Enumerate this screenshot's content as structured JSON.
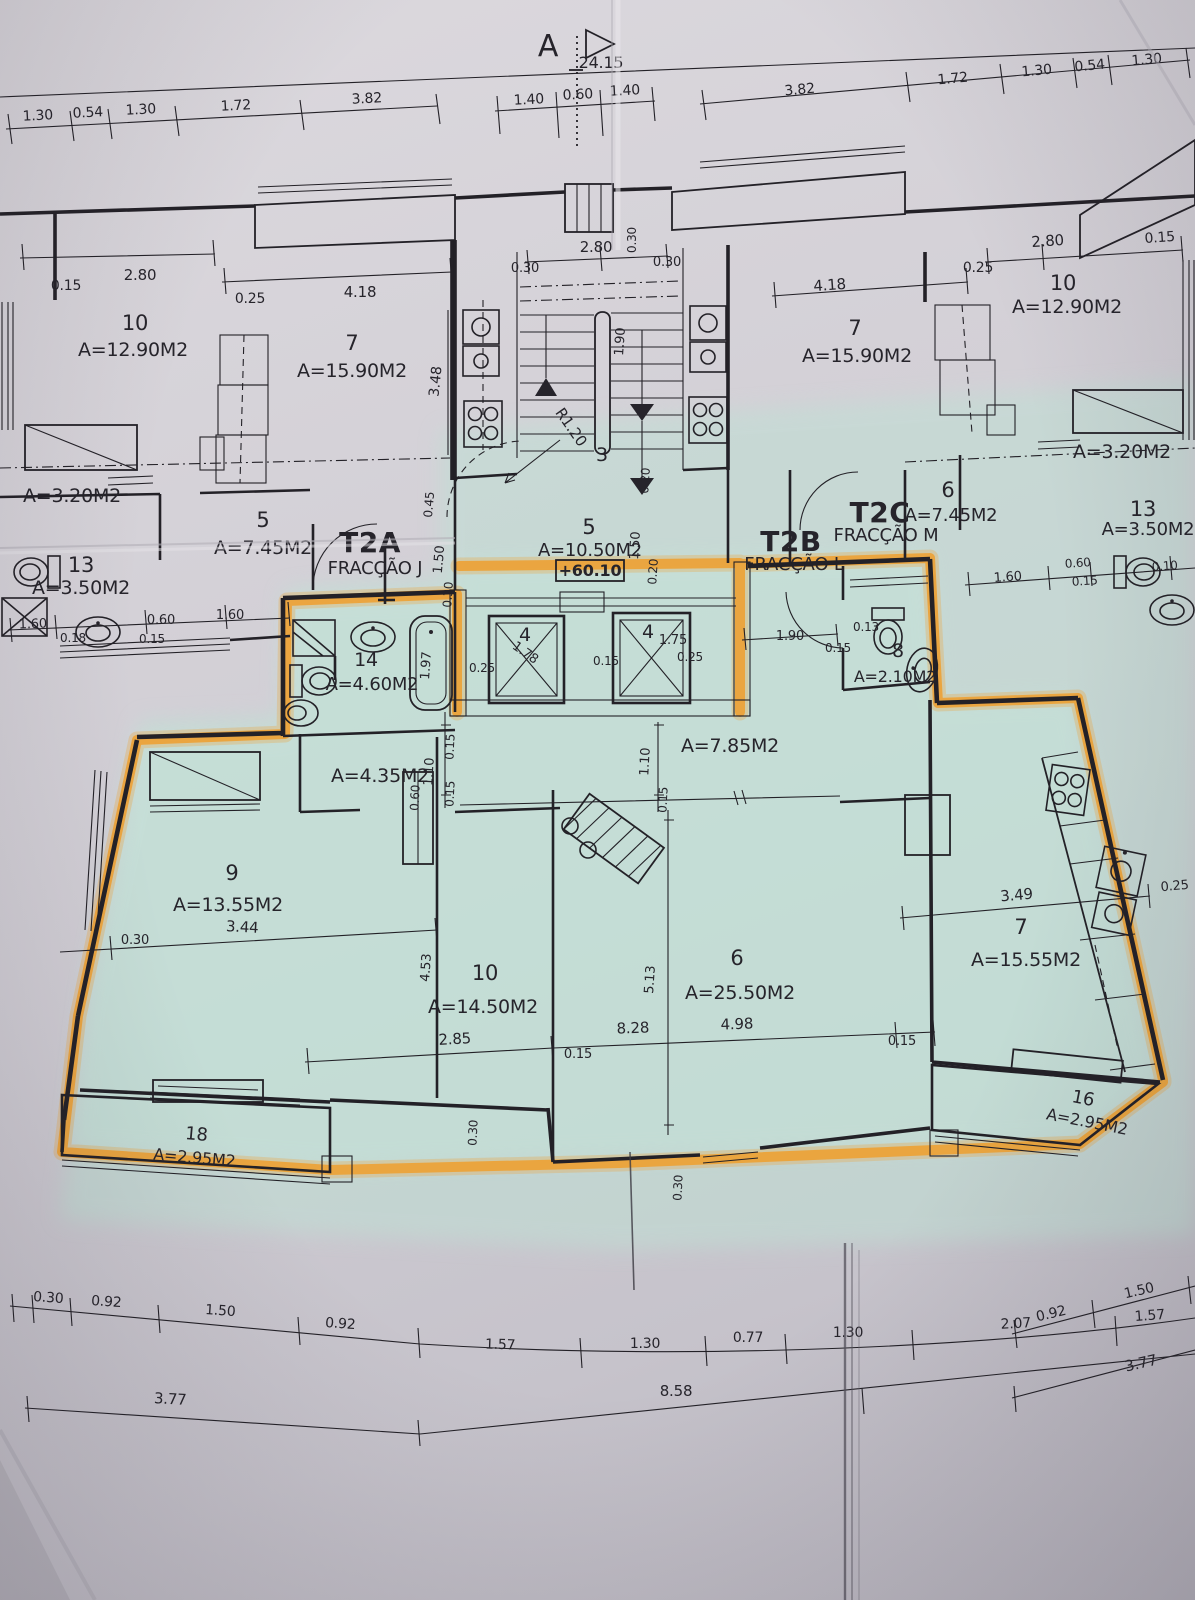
{
  "colors": {
    "highlighter": "#ef9f2e",
    "unit_tint": "#bfe0d4",
    "ink": "#26242b",
    "paper": "#d2cfd5"
  },
  "section": {
    "marker": "A",
    "total_width": "24.15"
  },
  "chains": {
    "top_left": [
      "1.30",
      "0.54",
      "1.30",
      "1.72",
      "3.82"
    ],
    "top_center": [
      "1.40",
      "0.60",
      "1.40"
    ],
    "top_right": [
      "3.82",
      "1.72",
      "1.30",
      "0.54",
      "1.30"
    ],
    "bottom_left": [
      "0.30",
      "0.92",
      "1.50",
      "0.92"
    ],
    "bottom_center": [
      "1.57",
      "1.30",
      "0.77",
      "1.30",
      "2.07",
      "1.57"
    ],
    "bottom_right": [
      "0.92",
      "1.50"
    ],
    "bottom_totals": [
      "3.77",
      "8.58",
      "3.77"
    ]
  },
  "fractions": {
    "t2a": {
      "code": "T2A",
      "name": "FRACÇÃO J"
    },
    "t2b": {
      "code": "T2B",
      "name": "FRACÇÃO L"
    },
    "t2c": {
      "code": "T2C",
      "name": "FRACÇÃO M"
    }
  },
  "core": {
    "stair": "3",
    "radius": "R1.20",
    "hall5": "5",
    "hall5_area": "A=10.50M2",
    "level": "+60.10",
    "lift_l": "4",
    "lift_l_w": "1.78",
    "lift_r": "4",
    "lift_r_w": "1.75",
    "d280": "2.80",
    "d030_l": "0.30",
    "d030_r": "0.30",
    "d030_v": "0.30",
    "d190": "1.90",
    "d150": "1.50",
    "d020_a": "0.20",
    "d020_b": "0.20",
    "d025_l": "0.25",
    "d015_m": "0.15",
    "d025_r": "0.25",
    "d030_w": "0.30"
  },
  "upper_left": {
    "r10": "10",
    "r10_area": "A=12.90M2",
    "r7": "7",
    "r7_area": "A=15.90M2",
    "a320": "A=3.20M2",
    "r5": "5",
    "r5_area": "A=7.45M2",
    "r13": "13",
    "r13_area": "A=3.50M2",
    "d015": "0.15",
    "d280": "2.80",
    "d025": "0.25",
    "d418": "4.18",
    "d348": "3.48",
    "d160_a": "1.60",
    "d018": "0.18",
    "d060": "0.60",
    "d015_b": "0.15",
    "d160_b": "1.60",
    "d045": "0.45",
    "d150": "1.50"
  },
  "upper_right": {
    "r10": "10",
    "r10_area": "A=12.90M2",
    "r7": "7",
    "r7_area": "A=15.90M2",
    "a320": "A=3.20M2",
    "r6": "6",
    "r6_area": "A=7.45M2",
    "r13": "13",
    "r13_area": "A=3.50M2",
    "d280": "2.80",
    "d015": "0.15",
    "d025": "0.25",
    "d418": "4.18",
    "d160": "1.60",
    "d060": "0.60",
    "d015_b": "0.15",
    "d010": "0.10"
  },
  "unit": {
    "r14": "14",
    "r14_area": "A=4.60M2",
    "d197": "1.97",
    "wc8": "8",
    "wc8_area": "A=2.10M2",
    "d190": "1.90",
    "d015_wc": "0.15",
    "d013": "0.13",
    "hall_left_area": "A=4.35M2",
    "d110_l": "1.10",
    "d015_l1": "0.15",
    "d015_l2": "0.15",
    "d060_l": "0.60",
    "hall_right_area": "A=7.85M2",
    "d110_r": "1.10",
    "d015_r": "0.15",
    "r9": "9",
    "r9_area": "A=13.55M2",
    "d344": "3.44",
    "d030_l": "0.30",
    "r10": "10",
    "r10_area": "A=14.50M2",
    "d453": "4.53",
    "d285": "2.85",
    "d015_a": "0.15",
    "r6": "6",
    "r6_area": "A=25.50M2",
    "d513": "5.13",
    "d828": "8.28",
    "d498": "4.98",
    "d015_b": "0.15",
    "r7": "7",
    "r7_area": "A=15.55M2",
    "d349": "3.49",
    "d025": "0.25",
    "balc_l": "18",
    "balc_l_area": "A=2.95M2",
    "balc_r": "16",
    "balc_r_area": "A=2.95M2",
    "d030_b1": "0.30",
    "d030_b2": "0.30"
  }
}
